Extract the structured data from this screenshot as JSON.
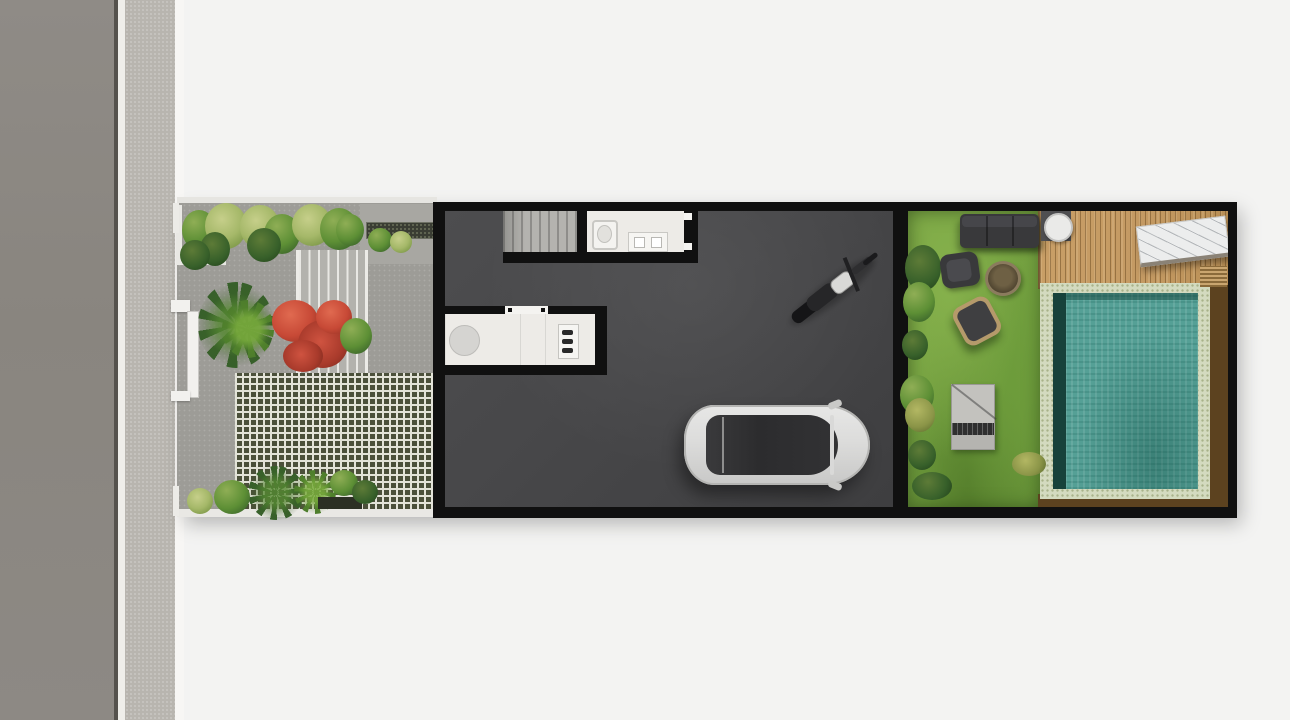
{
  "scene": {
    "type": "architectural-site-plan",
    "view": "top-down",
    "description": "Rendered top-down site plan of a narrow row-house lot beside a street: front garden with steps and grass-block paving, dark-floored garage hall with a motorcycle and a car, and a backyard with lawn, lounge furniture, wood deck and swimming pool.",
    "areas": [
      "street",
      "sidewalk",
      "front-garden",
      "entry-steps",
      "grass-block-paving",
      "carport-strip",
      "staircase",
      "bathroom",
      "kitchen-counter",
      "garage-hall",
      "motorcycle",
      "car",
      "backyard-lawn",
      "outdoor-lounge",
      "wood-deck",
      "swimming-pool",
      "pool-side-wood"
    ]
  },
  "palette": {
    "background": "#f3f3f2",
    "road": "#8d8984",
    "road_edge": "#55524d",
    "curb": "#efeeea",
    "sidewalk": "#b8b5af",
    "paving": "#9d9c97",
    "paving_light": "#a8a7a2",
    "steps": "#b3b2ad",
    "checker_light": "#e3e3d8",
    "checker_dark": "#4b503a",
    "carport": "#8f8e89",
    "wall": "#101010",
    "floor": "#474749",
    "stairs": "#b4b3af",
    "room_white": "#edebe7",
    "fixture": "#d5d4d1",
    "lawn": "#74a140",
    "lawn_light": "#86b14c",
    "lawn_dark": "#567f2c",
    "deck": "#c49a63",
    "pool_coping": "#d3dabf",
    "pool_water": "#55a096",
    "pool_edge_dark": "#17423b",
    "wood_dark": "#5c421f",
    "furniture": "#39393b",
    "car_body": "#dcdcdb",
    "car_glass": "#2c2c2e",
    "foliage": "#5d8f35",
    "foliage_dark": "#37602a",
    "foliage_light": "#a5b869",
    "flower_red": "#c74936"
  }
}
